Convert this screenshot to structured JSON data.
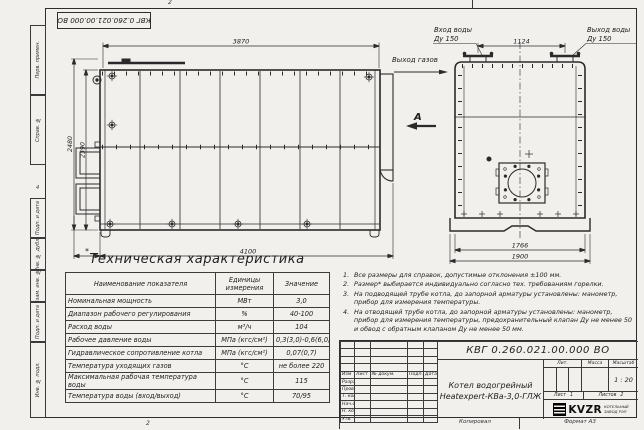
{
  "sheet": {
    "doc_number_stamp": "КВГ 0.260.021.00.000 ВО",
    "fold_mark_top": "2",
    "fold_mark_bottom": "2",
    "fold_mark_left": "4",
    "copied_label": "Копировал",
    "format_label": "Формат А3"
  },
  "margin_labels": [
    "Перв. примен.",
    "Справ. №",
    "Подп. и дата",
    "Инв. № дубл.",
    "Взам. инв. №",
    "Подп. и дата",
    "Инв. № подл."
  ],
  "front_view": {
    "dim_width_top": "3870",
    "dim_height_outer": "2480",
    "dim_height_inner": "2390",
    "dim_width_bottom": "4100",
    "dim_burner": "*"
  },
  "side_view": {
    "label_water_in": "Вход воды",
    "label_water_in_dn": "Ду 150",
    "label_water_out": "Выход воды",
    "label_water_out_dn": "Ду 150",
    "dim_pipes": "1124",
    "dim_body": "1766",
    "dim_base": "1900"
  },
  "annotations": {
    "gas_out": "Выход газов",
    "view_arrow": "А"
  },
  "table": {
    "title": "Техническая характеристика",
    "headers": [
      "Наименование показателя",
      "Единицы измерения",
      "Значение"
    ],
    "rows": [
      {
        "name": "Номинальная мощность",
        "unit": "МВт",
        "value": "3,0"
      },
      {
        "name": "Диапазон рабочего регулирования",
        "unit": "%",
        "value": "40-100"
      },
      {
        "name": "Расход воды",
        "unit": "м³/ч",
        "value": "104"
      },
      {
        "name": "Рабочее давление воды",
        "unit": "МПа (кгс/см²)",
        "value": "0,3(3,0)-0,6(6,0)"
      },
      {
        "name": "Гидравлическое сопротивление котла",
        "unit": "МПа (кгс/см²)",
        "value": "0,07(0,7)"
      },
      {
        "name": "Температура уходящих газов",
        "unit": "°С",
        "value": "не более 220"
      },
      {
        "name": "Максимальная рабочая температура воды",
        "unit": "°С",
        "value": "115"
      },
      {
        "name": "Температура воды (вход/выход)",
        "unit": "°С",
        "value": "70/95"
      }
    ]
  },
  "notes": [
    {
      "num": "1.",
      "text": "Все размеры для справок, допустимые отклонения ±100 мм."
    },
    {
      "num": "2.",
      "text": "Размер* выбирается индивидуально согласно тех. требованиям горелки."
    },
    {
      "num": "3.",
      "text": "На подводящей трубе котла, до запорной арматуры установлены: манометр, прибор для измерения температуры."
    },
    {
      "num": "4.",
      "text": "На отводящей трубе котла, до запорной арматуры установлены: манометр, прибор для измерения температуры, предохранительный клапан Ду не менее 50 и обвод с обратным клапаном Ду не менее 50 мм."
    }
  ],
  "title_block": {
    "doc_number": "КВГ 0.260.021.00.000 ВО",
    "product_name_line1": "Котел водогрейный",
    "product_name_line2": "Heatexpert-КВа-3,0-ГЛЖ",
    "header_cols": [
      "Изм",
      "Лист",
      "№ докум.",
      "Подп.",
      "Дата"
    ],
    "row_labels": [
      "Разраб.",
      "Пров.",
      "Т. контр.",
      "Нач.отд.",
      "Н. контр.",
      "Утв."
    ],
    "lit_label": "Лит.",
    "mass_label": "Масса",
    "scale_label": "Масштаб",
    "scale_value": "1 : 20",
    "sheet_label": "Лист",
    "sheet_value": "1",
    "sheets_label": "Листов",
    "sheets_value": "2",
    "company_logo": "KVZR",
    "company_name_line1": "КОТЕЛЬНЫЙ",
    "company_name_line2": "ЗАВОД РЭП"
  }
}
